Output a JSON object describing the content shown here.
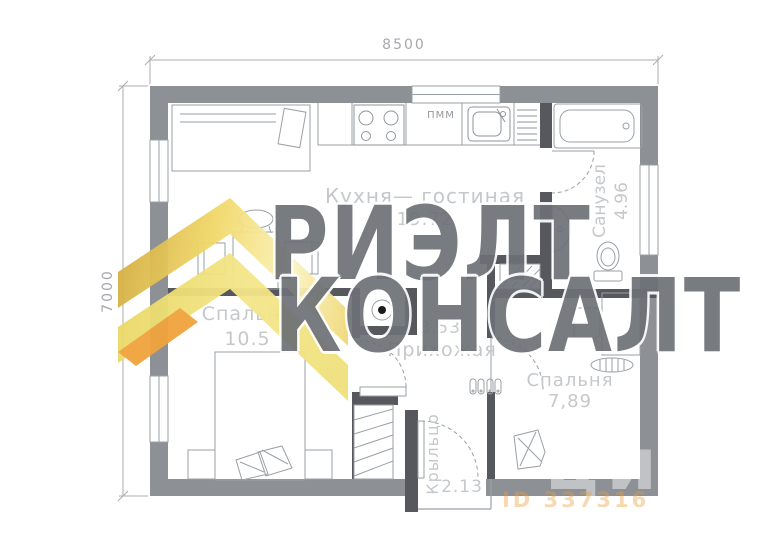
{
  "plan": {
    "dim_width": "8500",
    "dim_height": "7000",
    "rooms": [
      {
        "name": "Кухня— гостиная",
        "area": "19.72"
      },
      {
        "name": "Санузел",
        "area": "4.96"
      },
      {
        "name": "Спальня",
        "area": "10.5"
      },
      {
        "name": "Прихожая",
        "area": "3,53"
      },
      {
        "name": "Спальня",
        "area": "7,89"
      },
      {
        "name": "Крыльцо",
        "area": "2.13"
      }
    ],
    "appliance_labels": {
      "dishwasher": "ПММ"
    }
  },
  "watermark": {
    "agency_line1": "РИЭЛТ",
    "agency_line2": "КОНСАЛТ",
    "portal": "циан",
    "listing_id": "ID 337316",
    "logo_colors": {
      "gold": "#E8C654",
      "yellow": "#F2E175",
      "orange": "#F1A33C"
    }
  },
  "colors": {
    "outer_wall": "#8D9095",
    "inner_wall": "#56585E",
    "furniture_line": "#9AA0A6",
    "room_label": "#C5C8CB",
    "dim_label": "#A5A8AC",
    "watermark_text": "#6D7076"
  }
}
